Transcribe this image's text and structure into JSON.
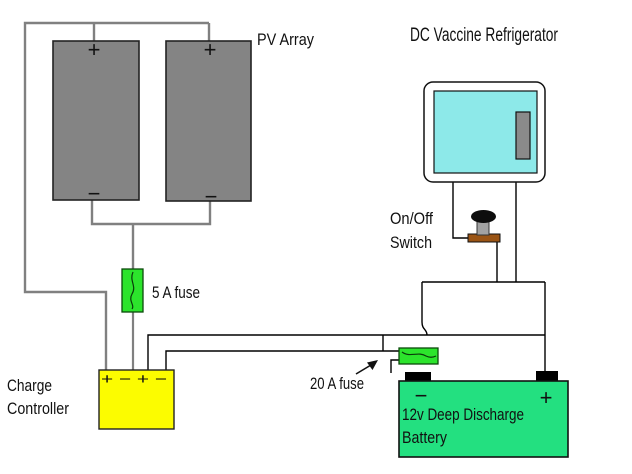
{
  "labels": {
    "pv_array": "PV Array",
    "refrigerator": "DC Vaccine Refrigerator",
    "switch_line1": "On/Off",
    "switch_line2": "Switch",
    "fuse_5a": "5 A fuse",
    "fuse_20a": "20 A fuse",
    "controller_line1": "Charge",
    "controller_line2": "Controller",
    "controller_terminals": "+ − + −",
    "battery_line1": "12v Deep Discharge",
    "battery_line2": "Battery"
  },
  "symbols": {
    "plus": "+",
    "minus": "−"
  },
  "colors": {
    "pv_panel": "#848484",
    "wire_gray": "#808080",
    "wire_black": "#000000",
    "fuse_green": "#2ce42c",
    "controller_yellow": "#fcfc00",
    "battery_green": "#23e080",
    "fridge_body": "#ffffff",
    "fridge_door": "#8de9e9",
    "fridge_handle": "#8a8a8a",
    "switch_base_brown": "#9a5414",
    "switch_stem": "#a2a2a2",
    "switch_knob": "#0d0d0d",
    "terminal_black": "#000000"
  }
}
